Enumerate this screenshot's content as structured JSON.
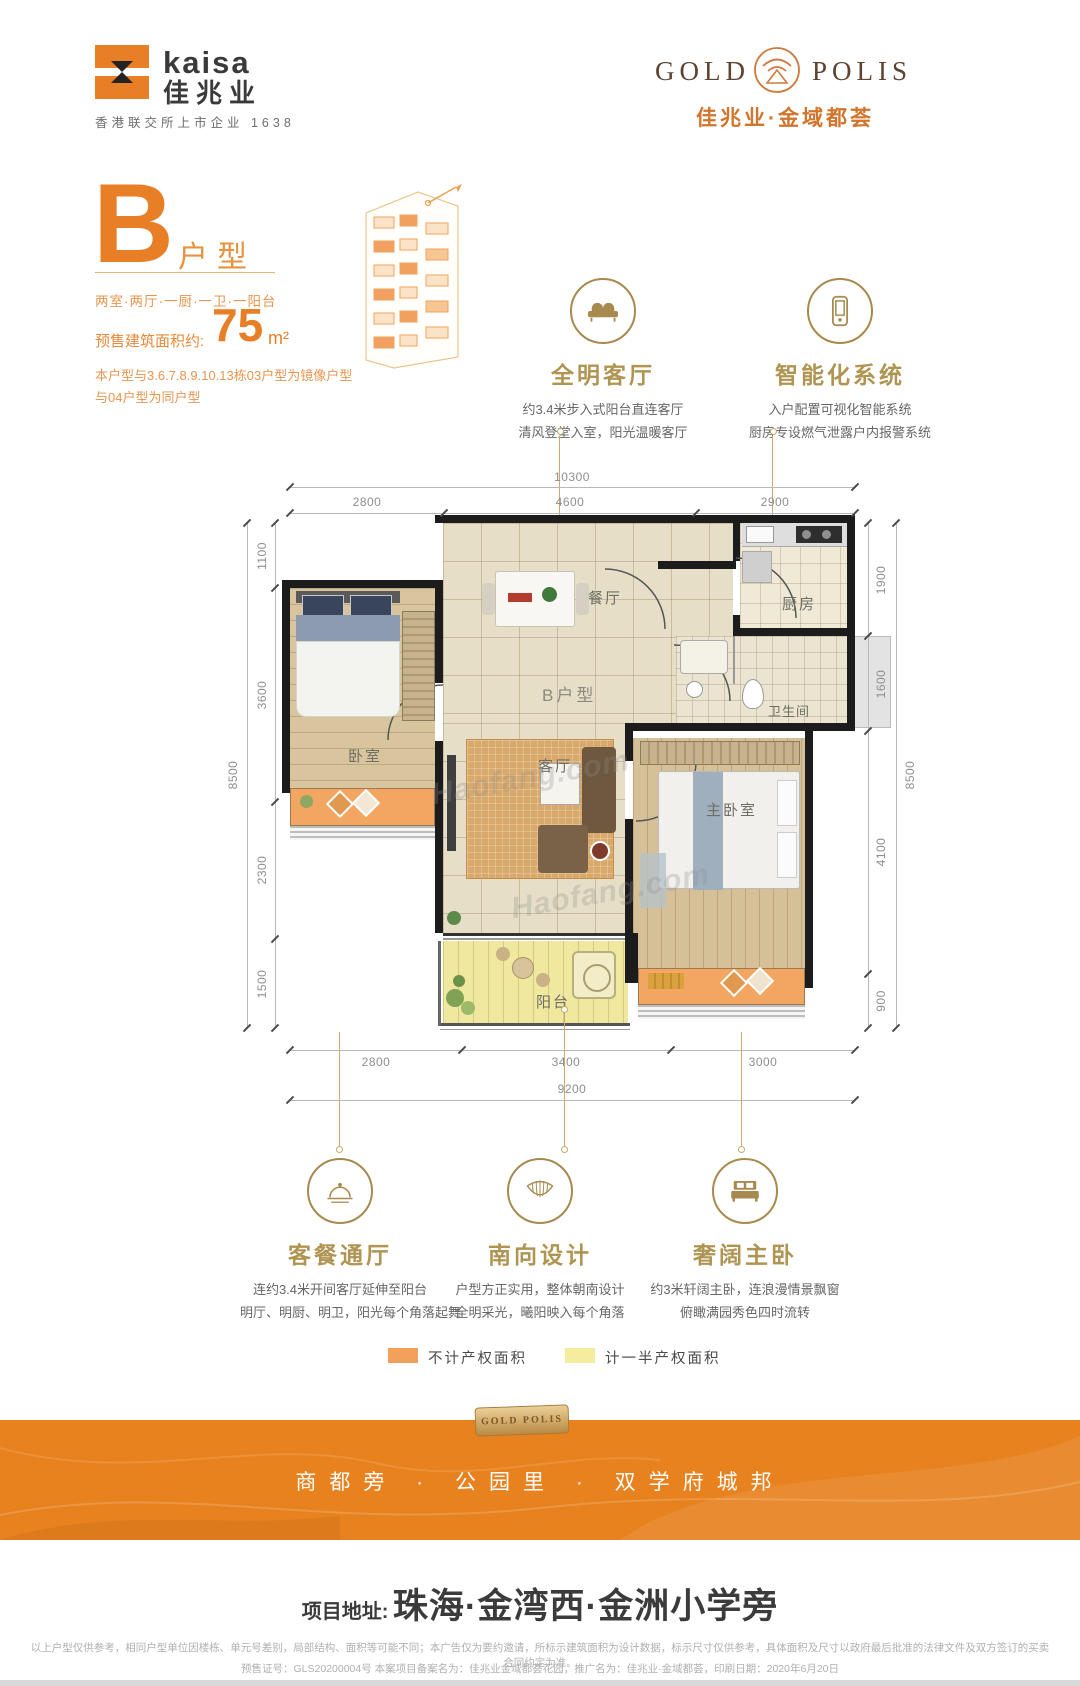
{
  "brand": {
    "kaisa_en": "kaisa",
    "kaisa_cn": "佳兆业",
    "kaisa_sub": "香港联交所上市企业 1638",
    "gold": "GOLD",
    "polis": "POLIS",
    "project_name": "佳兆业·金域都荟"
  },
  "unit": {
    "letter": "B",
    "type_suffix": "户型",
    "layout": "两室·两厅·一厨·一卫·一阳台",
    "area_label": "预售建筑面积约:",
    "area_value": "75",
    "area_unit": "m²",
    "note_line1": "本户型与3.6.7.8.9.10.13栋03户型为镜像户型",
    "note_line2": "与04户型为同户型"
  },
  "features_top": [
    {
      "icon": "sofa-icon",
      "title": "全明客厅",
      "line1": "约3.4米步入式阳台直连客厅",
      "line2": "清风登堂入室，阳光温暖客厅"
    },
    {
      "icon": "smartphone-icon",
      "title": "智能化系统",
      "line1": "入户配置可视化智能系统",
      "line2": "厨房专设燃气泄露户内报警系统"
    }
  ],
  "features_bottom": [
    {
      "icon": "cloche-icon",
      "title": "客餐通厅",
      "line1": "连约3.4米开间客厅延伸至阳台",
      "line2": "明厅、明厨、明卫，阳光每个角落起舞"
    },
    {
      "icon": "awning-icon",
      "title": "南向设计",
      "line1": "户型方正实用，整体朝南设计",
      "line2": "全明采光，曦阳映入每个角落"
    },
    {
      "icon": "bed-icon",
      "title": "奢阔主卧",
      "line1": "约3米轩阔主卧，连浪漫情景飘窗",
      "line2": "俯瞰满园秀色四时流转"
    }
  ],
  "plan": {
    "label": "B户型",
    "watermark": "Haofang.com",
    "rooms": {
      "dining": "餐厅",
      "kitchen": "厨房",
      "bath": "卫生间",
      "bedroom": "卧室",
      "living": "客厅",
      "master": "主卧室",
      "balcony": "阳台"
    },
    "dims": {
      "top_total": "10300",
      "top": [
        "2800",
        "4600",
        "2900"
      ],
      "left_total": "8500",
      "left": [
        "1100",
        "3600",
        "2300",
        "1500"
      ],
      "right_total": "8500",
      "right": [
        "1900",
        "1600",
        "4100",
        "900"
      ],
      "bottom": [
        "2800",
        "3400",
        "3000"
      ],
      "bottom_total": "9200"
    }
  },
  "legend": [
    {
      "label": "不计产权面积",
      "color": "#F2A05A"
    },
    {
      "label": "计一半产权面积",
      "color": "#F5EC9E"
    }
  ],
  "banner": {
    "badge": "GOLD POLIS",
    "slogan": "商都旁 · 公园里 · 双学府城邦"
  },
  "footer": {
    "address_label": "项目地址:",
    "address": "珠海·金湾西·金洲小学旁",
    "disclaimer1": "以上户型仅供参考，相同户型单位因楼栋、单元号差别，局部结构、面积等可能不同；本广告仅为要约邀请，所标示建筑面积为设计数据，标示尺寸仅供参考，具体面积及尺寸以政府最后批准的法律文件及双方签订的买卖合同约定为准。",
    "disclaimer2": "预售证号：GLS20200004号 本案项目备案名为：佳兆业金域都荟花园，推广名为：佳兆业·金域都荟，印刷日期：2020年6月20日"
  },
  "colors": {
    "brand_orange": "#E87E26",
    "gold": "#A8894E",
    "band_orange": "#E8821F"
  }
}
